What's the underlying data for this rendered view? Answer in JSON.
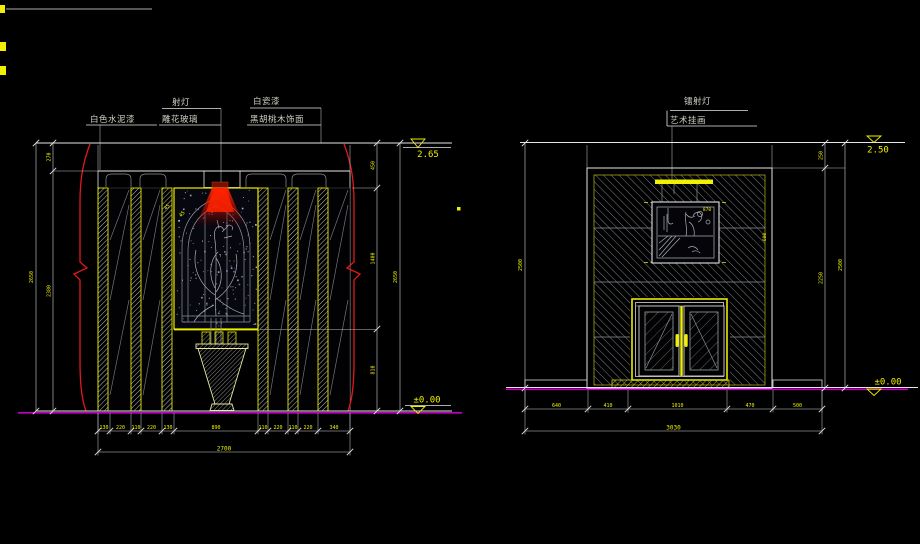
{
  "colors": {
    "background": "#000000",
    "line_white": "#e6e6e6",
    "accent_yellow": "#f0f000",
    "hatch_gray": "#9aa0a8",
    "floor_magenta": "#c400c4",
    "highlight_red": "#ff2200"
  },
  "left_drawing": {
    "labels": {
      "spot_light": "射灯",
      "white_cement_paint": "白色水泥漆",
      "carved_glass": "雕花玻璃",
      "white_lacquer": "白瓷漆",
      "black_walnut_veneer": "黑胡桃木饰面"
    },
    "elevation_top": "2.65",
    "elevation_floor": "±0.00",
    "panel_note_left": "45",
    "panel_note_right": "45",
    "dims": {
      "bottom_segments": [
        "130",
        "220",
        "110",
        "220",
        "130",
        "890",
        "110",
        "220",
        "110",
        "220",
        "340"
      ],
      "bottom_total": "2700",
      "left_segments": [
        "270",
        "2380"
      ],
      "left_total": "2650",
      "right_segments": [
        "450",
        "1400",
        "810"
      ],
      "right_total": "2650"
    }
  },
  "right_drawing": {
    "labels": {
      "laser_light": "镭射灯",
      "art_picture": "艺术挂画"
    },
    "elevation_top": "2.50",
    "elevation_floor": "±0.00",
    "picture_note": "870",
    "wall_note": "600",
    "dims": {
      "bottom_segments": [
        "640",
        "410",
        "1010",
        "470",
        "500"
      ],
      "bottom_total": "3030",
      "right_segments": [
        "250",
        "2250"
      ],
      "right_total": "2500",
      "left_total": "2500"
    }
  }
}
